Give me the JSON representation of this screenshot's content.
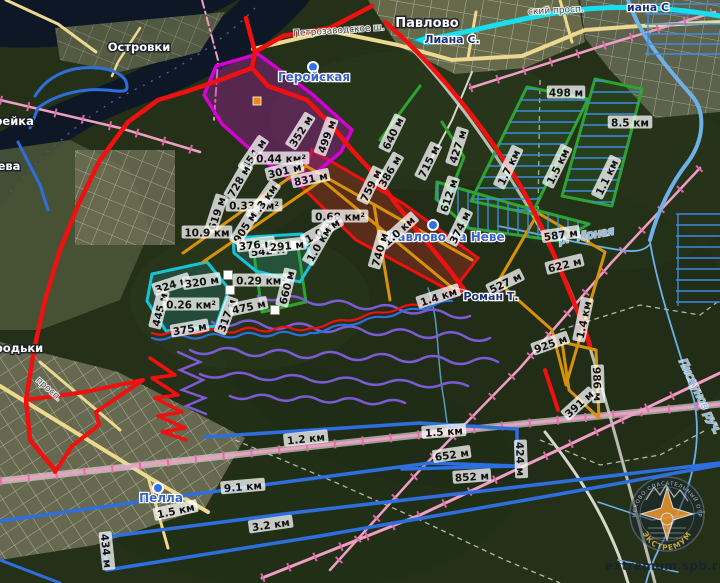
{
  "map": {
    "attribution": "extremum.spb.ru",
    "logo": {
      "ring_top": "ПОИСКОВО-СПАСАТЕЛЬНЫЙ ОТРЯД",
      "ring_bottom": "ЭКСТРЕМУМ"
    },
    "places": [
      {
        "text": "Павлово",
        "x": 427,
        "y": 27,
        "style": "town",
        "rot": 0
      },
      {
        "text": "Островки",
        "x": 139,
        "y": 51,
        "style": "townsm",
        "rot": 0
      },
      {
        "text": "рейка",
        "x": 14,
        "y": 125,
        "style": "townsm",
        "rot": 0
      },
      {
        "text": "ева",
        "x": 9,
        "y": 170,
        "style": "townsm",
        "rot": 0
      },
      {
        "text": "городьки",
        "x": 12,
        "y": 352,
        "style": "townsm",
        "rot": 0
      },
      {
        "text": "Геройская",
        "x": 314,
        "y": 81,
        "style": "station",
        "rot": 0
      },
      {
        "text": "Павлово на Неве",
        "x": 446,
        "y": 241,
        "style": "station",
        "rot": 0
      },
      {
        "text": "Пелла",
        "x": 161,
        "y": 502,
        "style": "station",
        "rot": 0
      },
      {
        "text": "Лиана С.",
        "x": 452,
        "y": 43,
        "style": "marker",
        "rot": 0
      },
      {
        "text": "иана С",
        "x": 648,
        "y": 11,
        "style": "marker",
        "rot": 0
      },
      {
        "text": "Роман Т.",
        "x": 491,
        "y": 300,
        "style": "marker",
        "rot": 0
      },
      {
        "text": "р. Чёрная",
        "x": 587,
        "y": 239,
        "style": "water",
        "rot": -10
      },
      {
        "text": "Пискунов руч.",
        "x": 697,
        "y": 398,
        "style": "water",
        "rot": 64
      },
      {
        "text": "Петрозаводское ш.",
        "x": 339,
        "y": 33,
        "style": "street",
        "rot": -4
      },
      {
        "text": "ский просп.",
        "x": 556,
        "y": 13,
        "style": "street",
        "rot": -3
      },
      {
        "text": "просп.",
        "x": 47,
        "y": 391,
        "style": "street",
        "rot": 42
      }
    ],
    "measurements": [
      {
        "text": "498 м",
        "x": 566,
        "y": 94,
        "rot": 0
      },
      {
        "text": "8.5 км",
        "x": 630,
        "y": 124,
        "rot": 0
      },
      {
        "text": "1.5 км",
        "x": 559,
        "y": 167,
        "rot": -64
      },
      {
        "text": "1.7 км",
        "x": 510,
        "y": 168,
        "rot": -64
      },
      {
        "text": "1.1 км",
        "x": 608,
        "y": 178,
        "rot": -64
      },
      {
        "text": "640 м",
        "x": 394,
        "y": 134,
        "rot": -64
      },
      {
        "text": "715 м",
        "x": 430,
        "y": 162,
        "rot": -64
      },
      {
        "text": "427 м",
        "x": 459,
        "y": 147,
        "rot": -72
      },
      {
        "text": "612 м",
        "x": 450,
        "y": 196,
        "rot": -72
      },
      {
        "text": "374 м",
        "x": 461,
        "y": 228,
        "rot": -64
      },
      {
        "text": "386 м",
        "x": 391,
        "y": 172,
        "rot": -60
      },
      {
        "text": "352 м",
        "x": 302,
        "y": 132,
        "rot": -58
      },
      {
        "text": "499 м",
        "x": 328,
        "y": 137,
        "rot": -70
      },
      {
        "text": "454 м",
        "x": 255,
        "y": 155,
        "rot": -56
      },
      {
        "text": "0.44 км²",
        "x": 281,
        "y": 160,
        "rot": 0
      },
      {
        "text": "301 м",
        "x": 285,
        "y": 172,
        "rot": -14
      },
      {
        "text": "728 м",
        "x": 240,
        "y": 182,
        "rot": -60
      },
      {
        "text": "831 м",
        "x": 311,
        "y": 180,
        "rot": -12
      },
      {
        "text": "759 м",
        "x": 372,
        "y": 186,
        "rot": -64
      },
      {
        "text": "0.33 км²",
        "x": 254,
        "y": 207,
        "rot": 0
      },
      {
        "text": "1.3 км",
        "x": 265,
        "y": 202,
        "rot": -55
      },
      {
        "text": "619 м",
        "x": 218,
        "y": 214,
        "rot": -72
      },
      {
        "text": "10.9 км",
        "x": 207,
        "y": 234,
        "rot": 0
      },
      {
        "text": "905 м",
        "x": 246,
        "y": 228,
        "rot": -58
      },
      {
        "text": "0.68 км²",
        "x": 340,
        "y": 218,
        "rot": 0
      },
      {
        "text": "1.0 км",
        "x": 323,
        "y": 232,
        "rot": -30
      },
      {
        "text": "1.0 км",
        "x": 400,
        "y": 232,
        "rot": -42
      },
      {
        "text": "1.0 км",
        "x": 320,
        "y": 245,
        "rot": -60
      },
      {
        "text": "740 м",
        "x": 381,
        "y": 250,
        "rot": -74
      },
      {
        "text": "527 м",
        "x": 506,
        "y": 284,
        "rot": -26
      },
      {
        "text": "587 м",
        "x": 561,
        "y": 236,
        "rot": -8
      },
      {
        "text": "622 м",
        "x": 565,
        "y": 266,
        "rot": -14
      },
      {
        "text": "925 м",
        "x": 551,
        "y": 345,
        "rot": -20
      },
      {
        "text": "1.4 км",
        "x": 439,
        "y": 298,
        "rot": -18
      },
      {
        "text": "1.4 км",
        "x": 585,
        "y": 320,
        "rot": -78
      },
      {
        "text": "986 м",
        "x": 596,
        "y": 384,
        "rot": 88
      },
      {
        "text": "391 м",
        "x": 580,
        "y": 405,
        "rot": -42
      },
      {
        "text": "652 м",
        "x": 452,
        "y": 456,
        "rot": -8
      },
      {
        "text": "1.2 км",
        "x": 306,
        "y": 440,
        "rot": -6
      },
      {
        "text": "1.5 км",
        "x": 444,
        "y": 433,
        "rot": -4
      },
      {
        "text": "424 м",
        "x": 519,
        "y": 459,
        "rot": 88
      },
      {
        "text": "852 м",
        "x": 472,
        "y": 478,
        "rot": -4
      },
      {
        "text": "9.1 км",
        "x": 243,
        "y": 488,
        "rot": -5
      },
      {
        "text": "1.5 км",
        "x": 176,
        "y": 512,
        "rot": -12
      },
      {
        "text": "3.2 км",
        "x": 271,
        "y": 526,
        "rot": -8
      },
      {
        "text": "434 м",
        "x": 105,
        "y": 551,
        "rot": 84
      },
      {
        "text": "324 м",
        "x": 172,
        "y": 286,
        "rot": -18
      },
      {
        "text": "320 м",
        "x": 202,
        "y": 283,
        "rot": -8
      },
      {
        "text": "445 м",
        "x": 161,
        "y": 310,
        "rot": -76
      },
      {
        "text": "0.26 км²",
        "x": 191,
        "y": 306,
        "rot": 0
      },
      {
        "text": "375 м",
        "x": 190,
        "y": 330,
        "rot": -10
      },
      {
        "text": "317 м",
        "x": 228,
        "y": 316,
        "rot": -70
      },
      {
        "text": "475 м",
        "x": 249,
        "y": 308,
        "rot": -12
      },
      {
        "text": "0.29 км²",
        "x": 261,
        "y": 282,
        "rot": 0
      },
      {
        "text": "660 м",
        "x": 288,
        "y": 288,
        "rot": -76
      },
      {
        "text": "542 м",
        "x": 268,
        "y": 252,
        "rot": -6
      },
      {
        "text": "376 м",
        "x": 256,
        "y": 246,
        "rot": -6
      },
      {
        "text": "291 м",
        "x": 287,
        "y": 247,
        "rot": -6
      }
    ],
    "markers": {
      "station_dots": [
        [
          313,
          67
        ],
        [
          433,
          225
        ],
        [
          158,
          488
        ]
      ],
      "waypoint_squares": [
        [
          242,
          245
        ],
        [
          295,
          245
        ],
        [
          228,
          275
        ],
        [
          230,
          290
        ],
        [
          275,
          310
        ]
      ],
      "orange_square": [
        257,
        101
      ],
      "cyan_arrow": {
        "x": 421,
        "y": 40
      },
      "red_flag": {
        "x": 456,
        "y": 292
      }
    }
  },
  "colors": {
    "route_red": "#ef1010",
    "magenta": "#d400d4",
    "orange": "#d8920a",
    "green": "#2fa32f",
    "cyan": "#17c3d4",
    "track_blue": "#2e6fe0",
    "lane_blue": "#3f8fe8",
    "purple": "#7e5bd6",
    "railway_pink": "#ef9ec5",
    "railway_tick": "#e06da8",
    "stream_blue": "#6fb0e8",
    "cyan_route": "#17dff2",
    "river_fill": "#0d1726",
    "station_blue": "#2f72e8",
    "place_label_blue": "#3b62c4",
    "water_label": "#7ab8f2",
    "logo_gold": "#d9b945"
  }
}
